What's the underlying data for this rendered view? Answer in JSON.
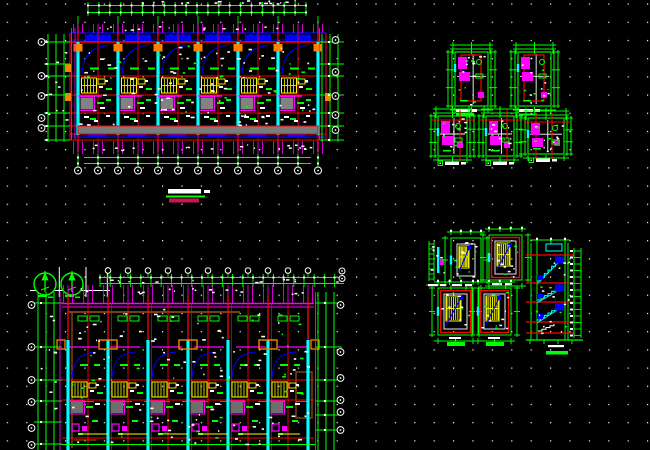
{
  "viewport": {
    "width": 650,
    "height": 450,
    "background": "#000000"
  },
  "dot_grid": {
    "color": "#ffffff",
    "spacing_x": 19.4,
    "spacing_y": 18.2,
    "offset_x": 6.8,
    "offset_y": 3.5,
    "dot_size": 1.2
  },
  "palette": {
    "red": "#ff0000",
    "green": "#00ff00",
    "cyan": "#00ffff",
    "blue": "#0000ff",
    "magenta": "#ff00ff",
    "yellow": "#ffff00",
    "white": "#ffffff",
    "gray": "#828282",
    "dark_gray": "#6e6e6e",
    "orange": "#ff7f00",
    "brown": "#8b4513",
    "crimson": "#cc1458",
    "black": "#000000"
  },
  "plan_top": {
    "x0": 78,
    "x1": 318,
    "bays": 6,
    "body_top": 33,
    "body_bottom": 140,
    "band_lines_y": [
      42,
      76,
      95,
      113,
      126,
      134,
      140
    ],
    "corridor_y": 126,
    "corridor_h": 8,
    "left_bubbles_y": [
      42,
      76,
      96,
      118,
      128
    ],
    "right_bubbles_y": [
      40,
      72,
      96,
      115,
      130
    ],
    "bottom_bubbles_y": 170.5,
    "caption": {
      "text_bar": [
        168,
        189,
        33,
        4.5
      ],
      "underline": [
        166,
        195.5,
        39,
        2
      ],
      "accent_bar": [
        169,
        198.5,
        30,
        4
      ]
    }
  },
  "fixture_details": [
    {
      "x": 455,
      "y": 52,
      "w": 33,
      "h": 54,
      "red": "frame",
      "cap": {
        "x": 456,
        "y": 109,
        "sym": false
      }
    },
    {
      "x": 518,
      "y": 52,
      "w": 33,
      "h": 54,
      "red": "frame",
      "cap": {
        "x": 519,
        "y": 109,
        "sym": false
      }
    },
    {
      "x": 438,
      "y": 116,
      "w": 29,
      "h": 40,
      "red": "cross",
      "cap": {
        "x": 438,
        "y": 161,
        "sym": true
      }
    },
    {
      "x": 486,
      "y": 116,
      "w": 28,
      "h": 40,
      "red": "cross",
      "cap": {
        "x": 486,
        "y": 161,
        "sym": true
      }
    },
    {
      "x": 528,
      "y": 118,
      "w": 36,
      "h": 36,
      "red": "cross2",
      "cap": {
        "x": 529,
        "y": 158,
        "sym": true
      }
    }
  ],
  "plan_bottom": {
    "x0": 68,
    "x1": 308,
    "bays": 6,
    "body_top": 303,
    "body_bottom": 450,
    "left_bubbles_y": [
      305,
      347,
      380,
      402,
      428,
      445
    ],
    "right_bubbles_y": [
      305,
      352,
      378,
      400,
      412,
      430
    ],
    "north_symbols": [
      {
        "cx": 45,
        "cy": 284,
        "r": 11
      },
      {
        "cx": 72,
        "cy": 284,
        "r": 11
      }
    ]
  },
  "stair_plans": [
    {
      "x": 429,
      "y": 241,
      "w": 15,
      "h": 40,
      "kind": "narrow",
      "cap": {
        "x": 428,
        "y": 284,
        "bar": false
      }
    },
    {
      "x": 451,
      "y": 238,
      "w": 30,
      "h": 44,
      "kind": "plain",
      "cap": {
        "x": 452,
        "y": 284,
        "bar": false
      }
    },
    {
      "x": 489,
      "y": 235,
      "w": 33,
      "h": 45,
      "kind": "red",
      "cap": {
        "x": 492,
        "y": 283,
        "bar": false
      }
    },
    {
      "x": 438,
      "y": 288,
      "w": 35,
      "h": 47,
      "kind": "red",
      "cap": {
        "x": 447,
        "y": 342,
        "bar": true
      }
    },
    {
      "x": 478,
      "y": 288,
      "w": 33,
      "h": 47,
      "kind": "red",
      "cap": {
        "x": 486,
        "y": 342,
        "bar": true
      }
    }
  ],
  "stair_section": {
    "x": 528,
    "y": 243,
    "floors_dy": [
      12,
      40,
      59,
      79,
      90
    ],
    "h": 94,
    "cap": [
      546,
      351
    ]
  }
}
